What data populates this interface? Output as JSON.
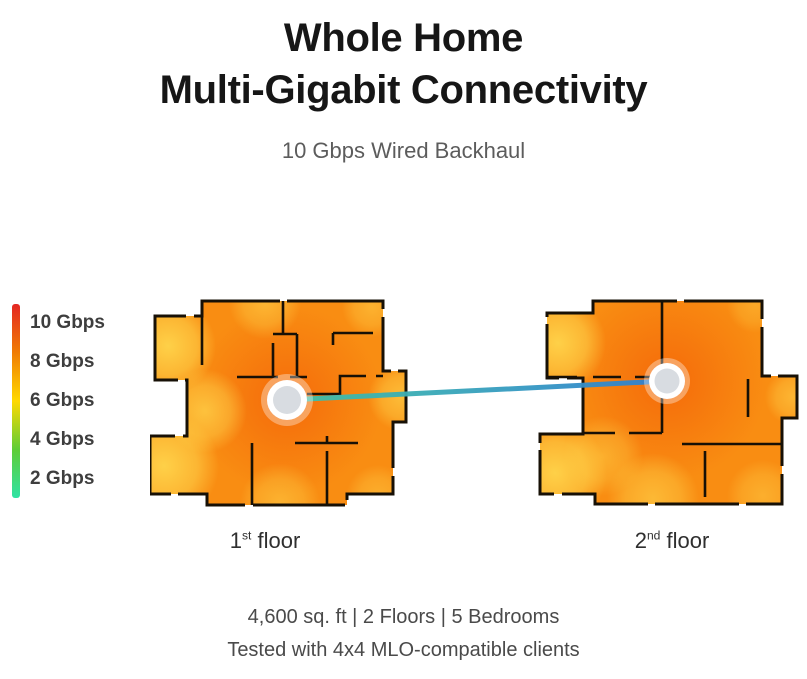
{
  "title": {
    "line1": "Whole Home",
    "line2": "Multi-Gigabit Connectivity"
  },
  "subtitle": "10 Gbps Wired Backhaul",
  "legend": {
    "items": [
      {
        "label": "10 Gbps"
      },
      {
        "label": "8 Gbps"
      },
      {
        "label": "6 Gbps"
      },
      {
        "label": "4 Gbps"
      },
      {
        "label": "2 Gbps"
      }
    ],
    "gradient": [
      "#e42723",
      "#f07c04",
      "#ffd900",
      "#5ecd36",
      "#2fe2a4"
    ]
  },
  "heatmap": {
    "base": "#f98d12",
    "strong": "#f4690a",
    "weak": "#ffd84e"
  },
  "node": {
    "fill": "#ffffff",
    "inner": "#d8dce1"
  },
  "connection": {
    "start": "#3fc3a7",
    "end": "#2f7fd2"
  },
  "floors": [
    {
      "number": "1",
      "ordinal": "st",
      "word": " floor"
    },
    {
      "number": "2",
      "ordinal": "nd",
      "word": " floor"
    }
  ],
  "footer": {
    "line1": "4,600 sq. ft | 2 Floors | 5 Bedrooms",
    "line2": "Tested with 4x4 MLO-compatible clients"
  }
}
